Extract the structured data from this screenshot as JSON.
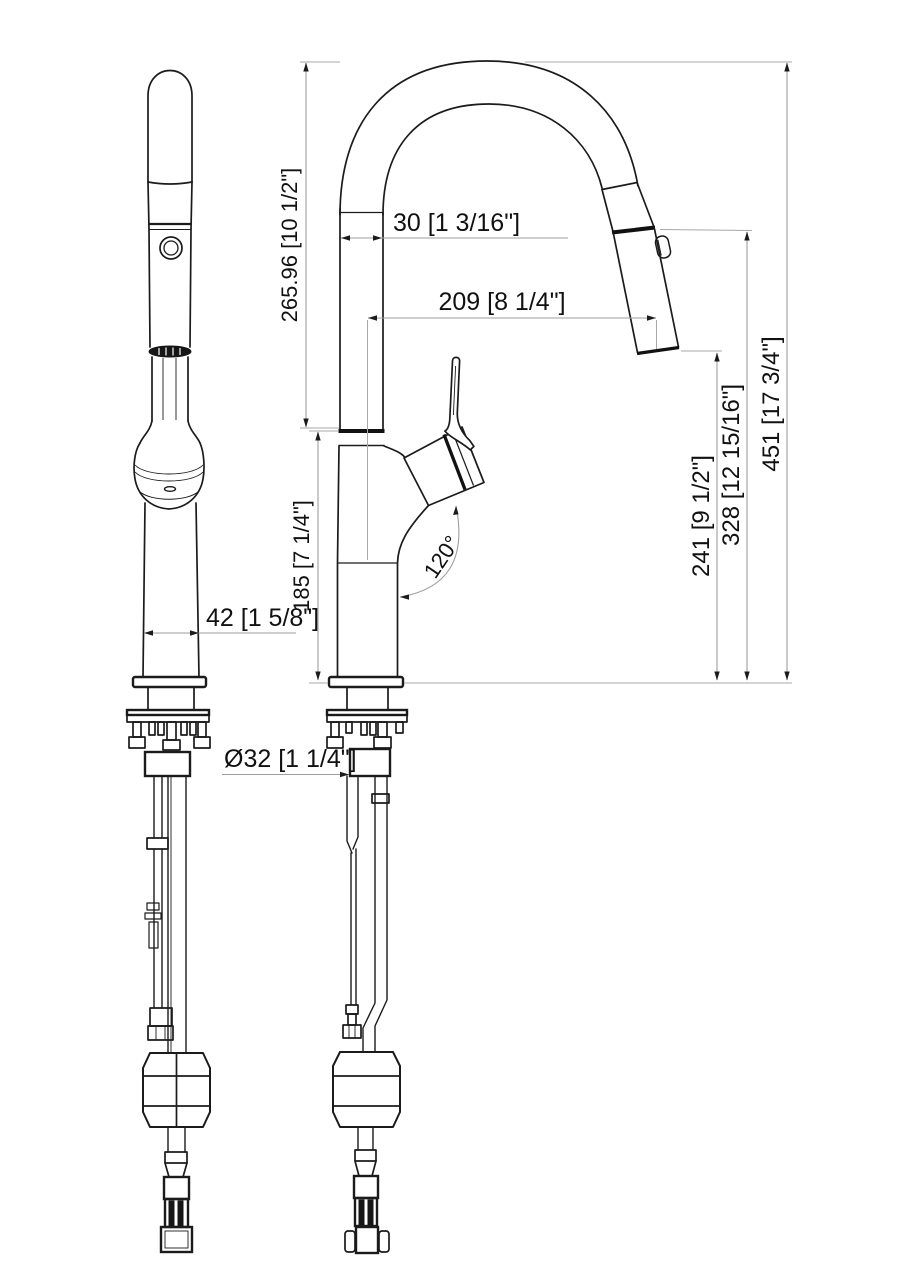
{
  "drawing": {
    "type": "faucet-installation-dimension-drawing",
    "views": {
      "front_view": "faucet front elevation with supply hoses and weight",
      "side_view": "faucet side elevation with spout arc, handle, spray head"
    },
    "dimensions": {
      "spout_tube_width": "30 [1 3/16\"]",
      "spout_reach": "209 [8 1/4\"]",
      "spout_rise": "265.96 [10 1/2\"]",
      "body_height": "185 [7 1/4\"]",
      "outlet_height": "241 [9 1/2\"]",
      "head_seam_height": "328 [12 15/16\"]",
      "overall_height": "451 [17 3/4\"]",
      "handle_angle": "120°",
      "body_width": "42 [1 5/8\"]",
      "shank_diameter": "Ø32 [1 1/4\"]"
    },
    "colors": {
      "background": "#ffffff",
      "object_line": "#1b1b1b",
      "dimension_line": "#9e9e9e",
      "text": "#111111"
    }
  }
}
